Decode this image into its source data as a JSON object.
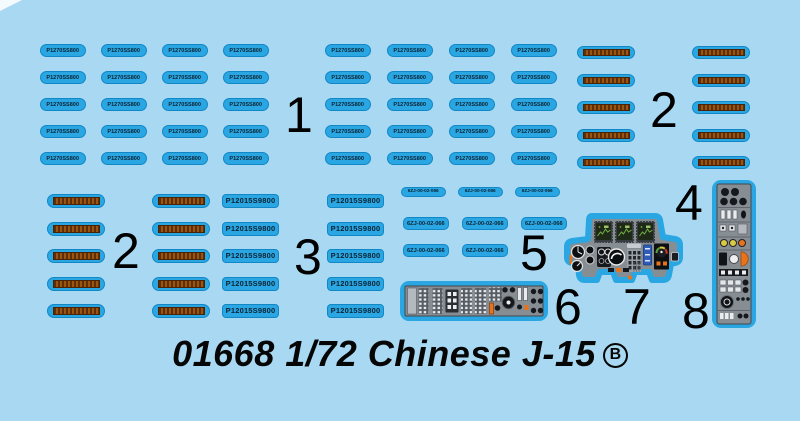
{
  "title": {
    "text": "01668 1/72 Chinese J-15",
    "letter": "B"
  },
  "group_labels": {
    "g1": "1",
    "g2_top": "2",
    "g2_mid": "2",
    "g3": "3",
    "g4": "4",
    "g5": "5",
    "g6": "6",
    "g7": "7",
    "g8": "8"
  },
  "stencils": {
    "small_text": "P1270SS800",
    "large_text": "P12015S9800",
    "code_text": "6ZJ-00-02-066"
  },
  "blocks": {
    "grid1a": {
      "kind": "pill-sm",
      "rows": 5,
      "cols": 4,
      "text": "small_text"
    },
    "grid1b": {
      "kind": "pill-sm",
      "rows": 5,
      "cols": 4,
      "text": "small_text"
    },
    "strips_top_left": {
      "kind": "strip",
      "rows": 5
    },
    "strips_top_right": {
      "kind": "strip",
      "rows": 5
    },
    "strips_mid_left": {
      "kind": "strip",
      "rows": 5
    },
    "strips_mid_right": {
      "kind": "strip",
      "rows": 5
    },
    "pills3_left": {
      "kind": "pill-lg",
      "rows": 5,
      "text": "large_text"
    },
    "pills3_right": {
      "kind": "pill-lg",
      "rows": 5,
      "text": "large_text"
    },
    "codes_row1": {
      "kind": "pill-code-sm",
      "count": 3,
      "text": "code_text"
    },
    "codes_row2": {
      "kind": "pill-code",
      "count": 3,
      "text": "code_text"
    },
    "codes_row3": {
      "kind": "pill-code",
      "count": 2,
      "text": "code_text"
    }
  },
  "colors": {
    "background": "#a9d9f2",
    "decal_blue": "#2aa7e2",
    "decal_edge": "#1187c6",
    "strip_brown": "#9a5510",
    "strip_brown_dark": "#5f2d06",
    "stencil_text": "#0d2233",
    "console_gray": "#868d93",
    "console_light": "#b3b9bf",
    "console_dark": "#2b2f34",
    "accent_orange": "#e8731a",
    "accent_yellow": "#d9c943",
    "screen_green": "#74b043",
    "display_blue": "#2e5cb8",
    "ink": "#000000"
  }
}
